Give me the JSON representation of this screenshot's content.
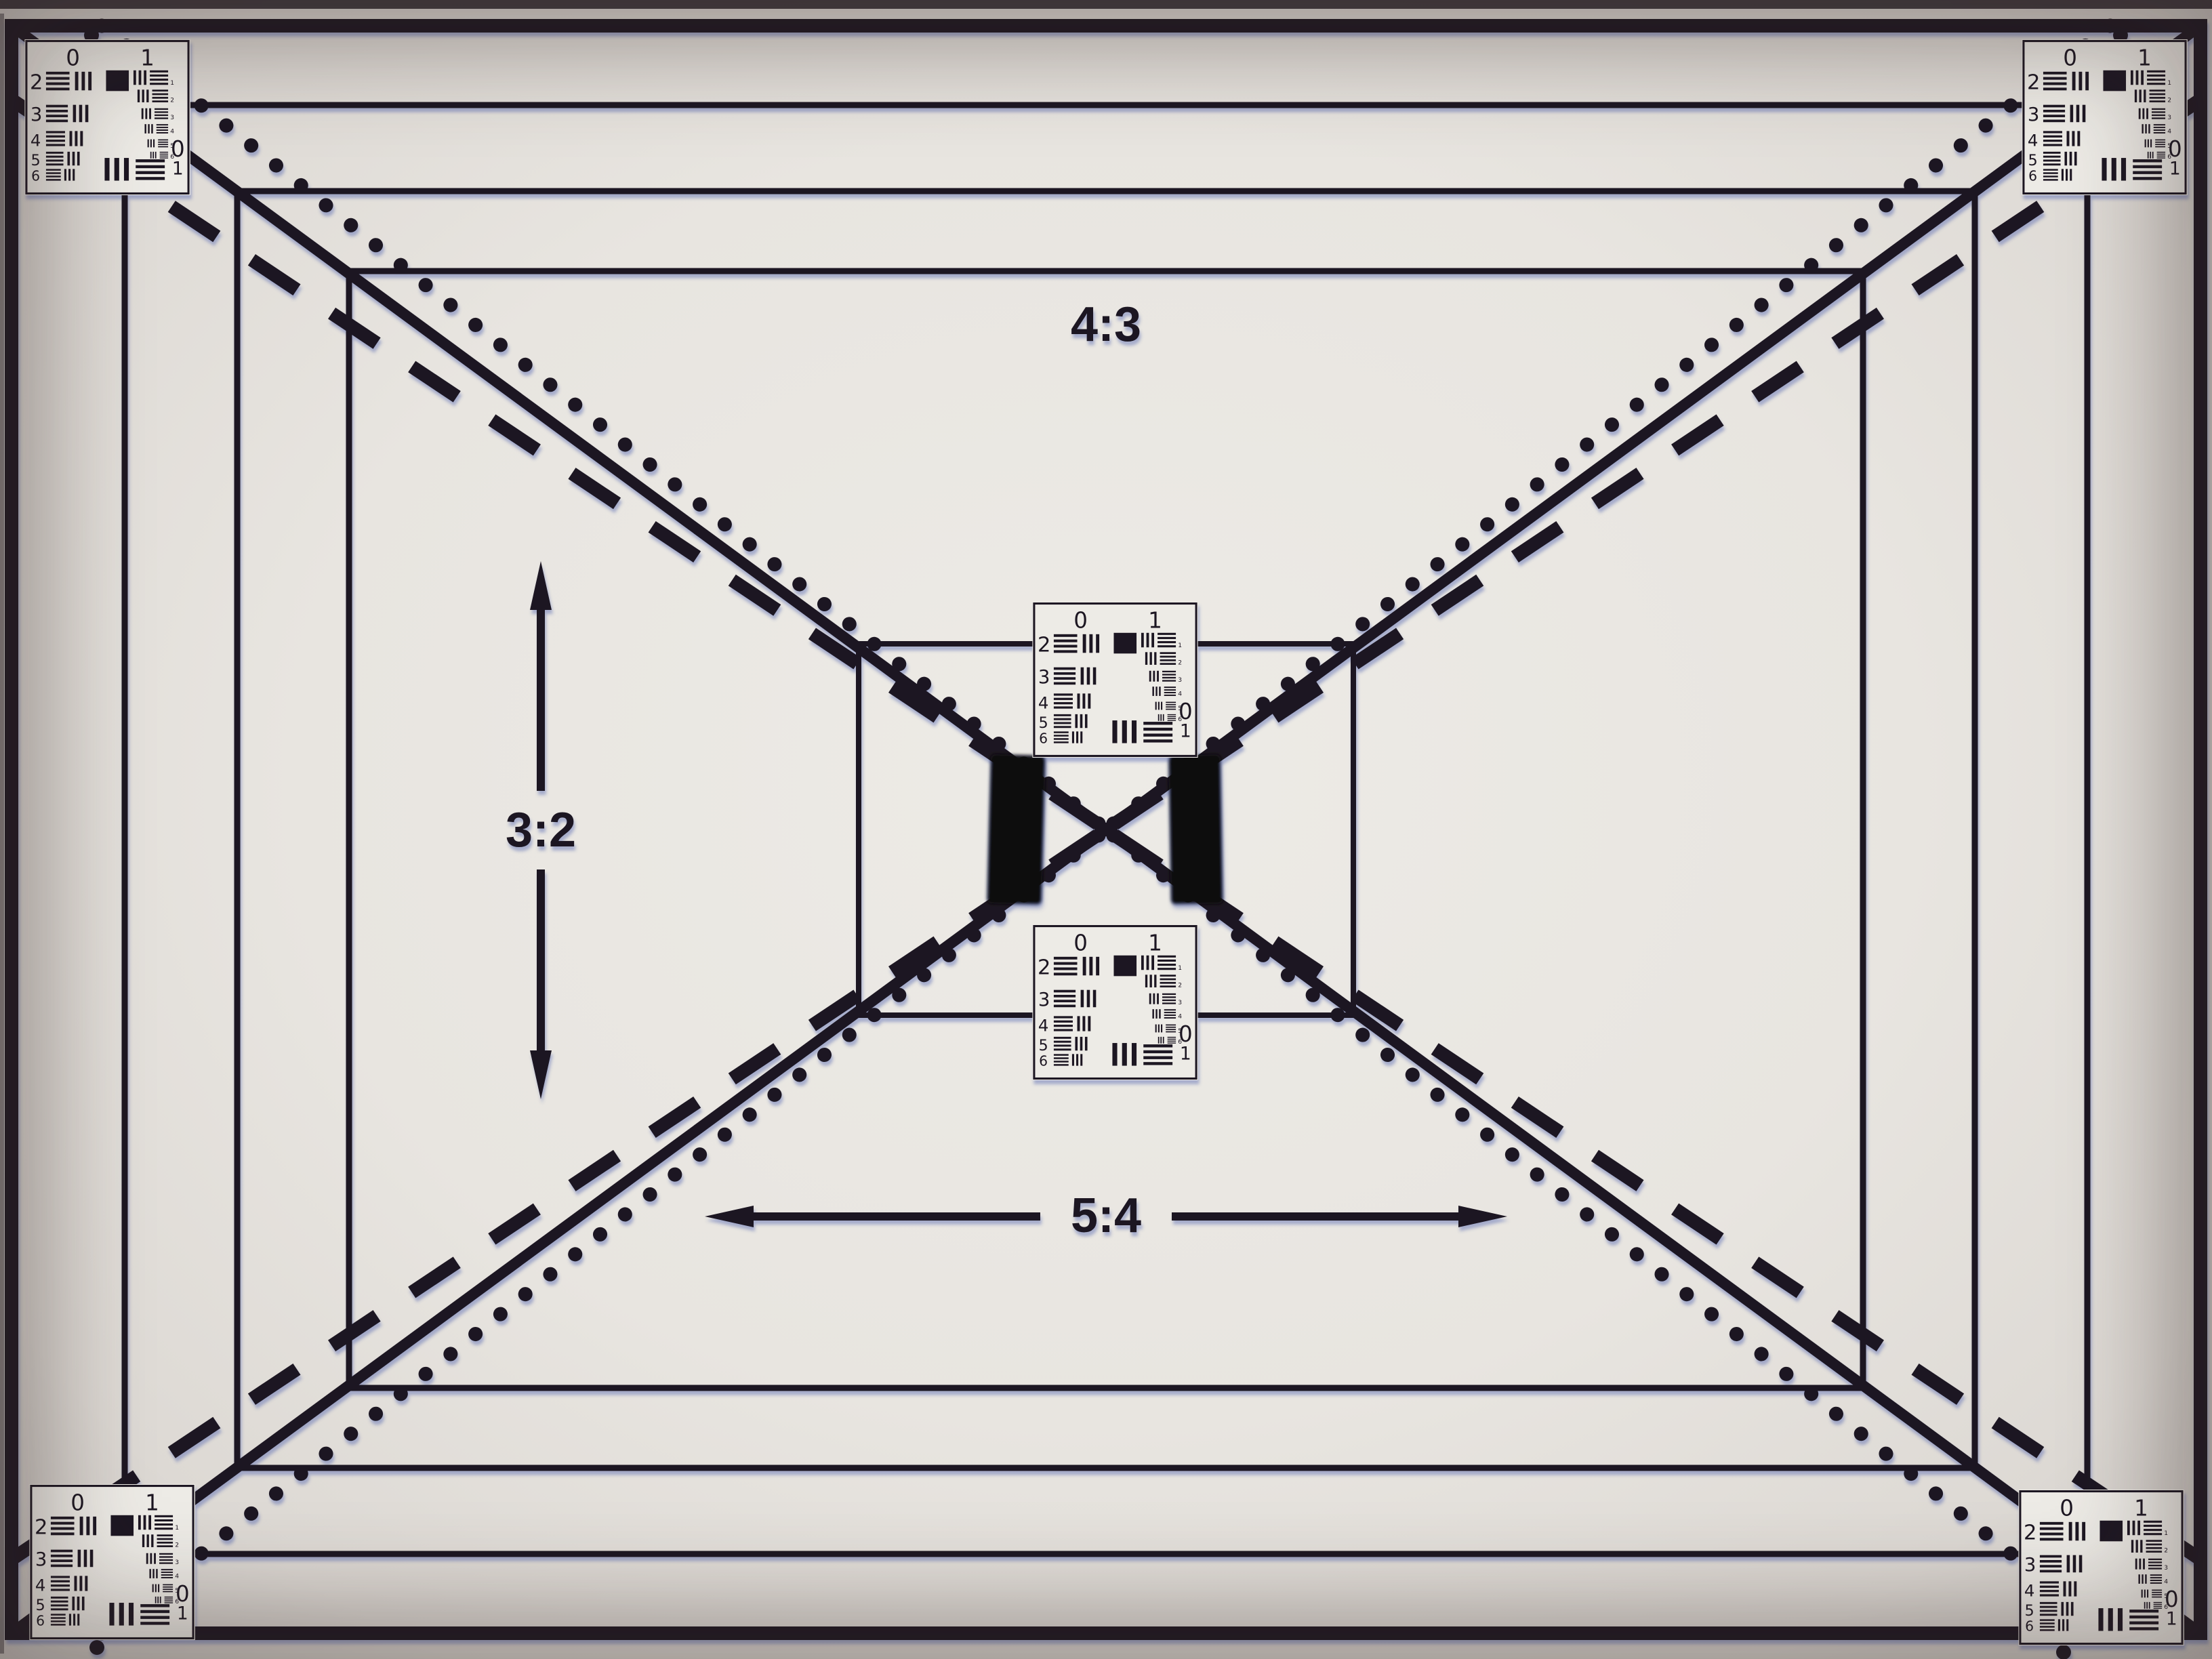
{
  "labels": {
    "aspect_top": "4:3",
    "aspect_left": "3:2",
    "aspect_bottom": "5:4"
  },
  "target": {
    "scale_left": "0",
    "scale_right": "1",
    "rows": [
      "2",
      "3",
      "4",
      "5",
      "6"
    ],
    "mini_indices": [
      "1",
      "2",
      "3",
      "4",
      "5",
      "6"
    ],
    "corner_zero": "0",
    "corner_one": "1"
  },
  "colors": {
    "ink": "#1d1621",
    "card": "#edebe6",
    "fringe": "#5566b0",
    "background": "#e8e5e0"
  }
}
